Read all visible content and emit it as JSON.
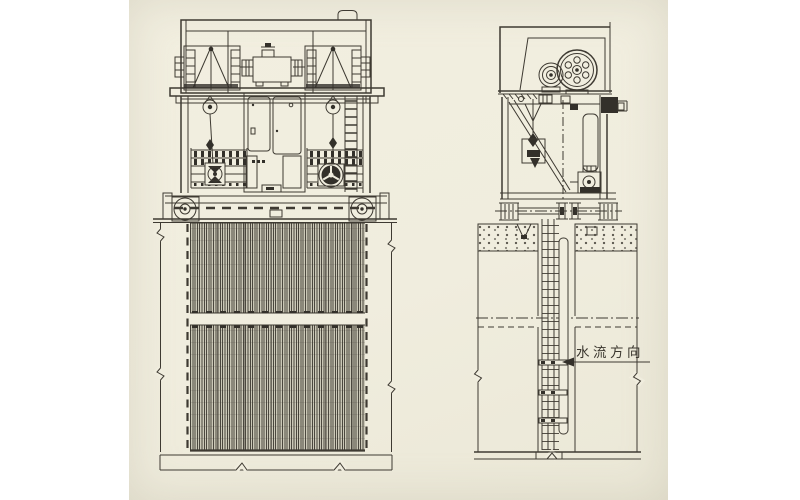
{
  "photo": {
    "type": "scanned engineering drawing",
    "subject": "mechanical bar screen machine, front and side elevations",
    "paper_color": "#f0edde",
    "ink_color": "#3e3a32",
    "page_background": "#ffffff"
  },
  "labels": {
    "flow_direction": "水流方向"
  }
}
